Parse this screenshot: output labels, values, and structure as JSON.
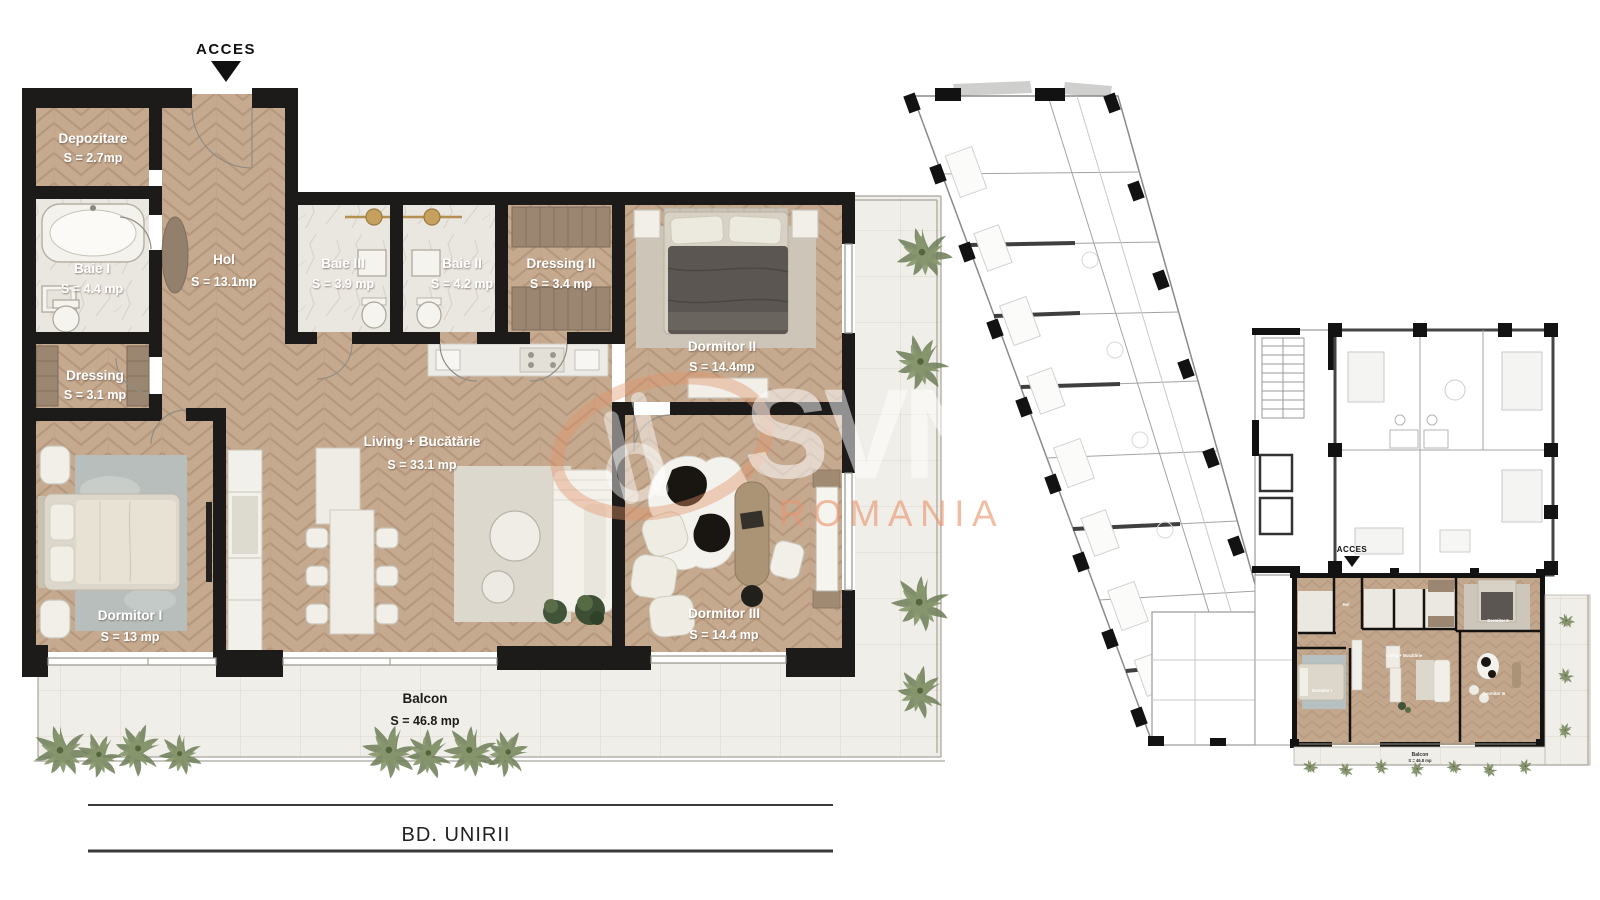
{
  "watermark": {
    "brand": "SVN",
    "region": "ROMANIA"
  },
  "main_plan": {
    "acces": "ACCES",
    "street": "BD. UNIRII",
    "rooms": {
      "depozitare": {
        "name": "Depozitare",
        "area": "S = 2.7mp"
      },
      "baie_i": {
        "name": "Baie I",
        "area": "S = 4.4 mp"
      },
      "hol": {
        "name": "Hol",
        "area": "S = 13.1mp"
      },
      "baie_iii": {
        "name": "Baie III",
        "area": "S = 3.9 mp"
      },
      "baie_ii": {
        "name": "Baie II",
        "area": "S = 4.2 mp"
      },
      "dressing_ii": {
        "name": "Dressing II",
        "area": "S = 3.4 mp"
      },
      "dormitor_ii": {
        "name": "Dormitor II",
        "area": "S = 14.4mp"
      },
      "dressing": {
        "name": "Dressing",
        "area": "S = 3.1 mp"
      },
      "living_bucatarie": {
        "name": "Living + Bucătărie",
        "area": "S = 33.1 mp"
      },
      "dormitor_i": {
        "name": "Dormitor I",
        "area": "S = 13 mp"
      },
      "dormitor_iii": {
        "name": "Dormitor III",
        "area": "S = 14.4 mp"
      },
      "balcon": {
        "name": "Balcon",
        "area": "S = 46.8 mp"
      }
    }
  },
  "overview_plan": {
    "acces": "ACCES",
    "balcon": "Balcon",
    "balcon_area": "S = 46.8 mp"
  },
  "colors": {
    "wall": "#1d1b19",
    "floor_tan": "#c6aa90",
    "marble": "#eae6df",
    "balcony": "#f0eee8",
    "accent_orange": "#e8966e",
    "plant_green": "#6f7f58"
  }
}
